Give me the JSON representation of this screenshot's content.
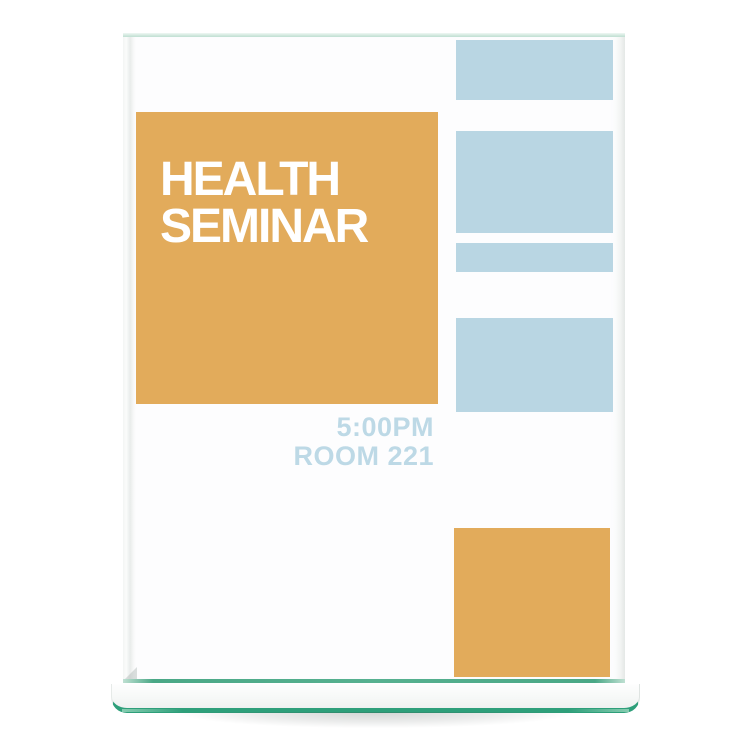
{
  "image": {
    "type": "product-photo",
    "subject": "Clear glass top-loading sign holder standing on a white background, displaying an event flyer"
  },
  "flyer": {
    "title_line1": "HEALTH",
    "title_line2": "SEMINAR",
    "time": "5:00PM",
    "room": "ROOM 221",
    "colors": {
      "title_block_bg": "#e2ab5b",
      "title_text": "#ffffff",
      "detail_text": "#bdd9e6",
      "accent_blue": "#b9d6e3",
      "accent_orange": "#e2ab5b",
      "paper": "#fdfdfe"
    },
    "decor": {
      "right_column_blue_block_count": 4,
      "bottom_right_orange_square": true
    }
  },
  "holder": {
    "glass_edge_green_dark": "#2e9f7a",
    "glass_edge_green_light": "#bfe0d2",
    "base_face": "#f6f8f7",
    "shadow": "rgba(55,65,62,0.22)"
  }
}
